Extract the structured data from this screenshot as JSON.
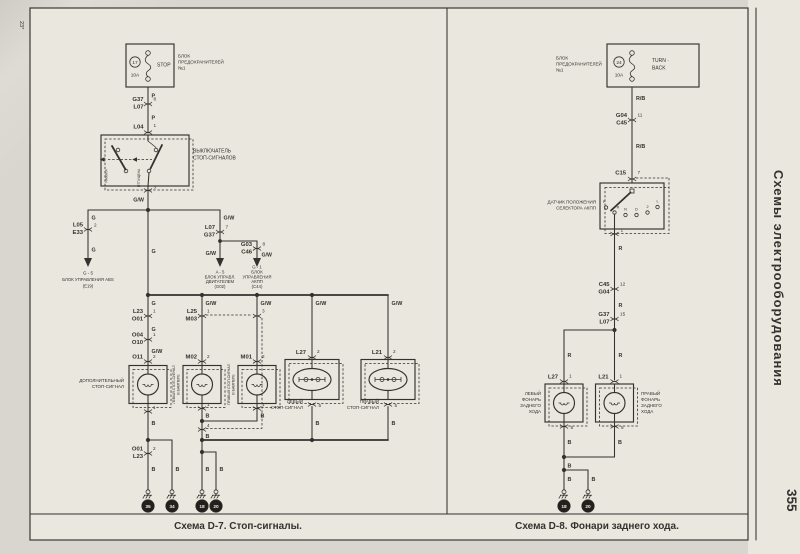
{
  "page": {
    "corner": "23*",
    "sidebar": "Схемы электрооборудования",
    "number": "355"
  },
  "colors": {
    "ink": "#33322e",
    "paper": "#eae7df",
    "page_bg": "#d9d6cf",
    "disc": "#21201c"
  },
  "d7": {
    "caption": "Схема D-7. Стоп-сигналы.",
    "fuse": {
      "num": "17",
      "amp": "10A",
      "name": "STOP",
      "box0": "БЛОК",
      "box1": "ПРЕДОХРАНИТЕЛЕЙ",
      "box2": "№1"
    },
    "w_p1": "P",
    "w_p2": "P",
    "cn1": {
      "a": "G37",
      "b": "L07",
      "pin": "8"
    },
    "cn2": {
      "a": "L04",
      "pin": "1"
    },
    "sw": {
      "name0": "ВЫКЛЮЧАТЕЛЬ",
      "name1": "СТОП-СИГНАЛОВ",
      "st0": "НАЖАТА",
      "st1": "ОТПУЩЕНА",
      "pin": "3",
      "out": "G/W"
    },
    "abs": {
      "w1": "G",
      "a": "L05",
      "b": "E33",
      "pin": "2",
      "w2": "G",
      "ref": "G - 5",
      "name": "БЛОК УПРАВЛЕНИЯ ABS",
      "code": "(E19)"
    },
    "ecu": {
      "w1": "G/W",
      "a": "L07",
      "b": "G37",
      "pin": "7",
      "w2": "G/W",
      "ref": "A - 5",
      "name0": "БЛОК УПРАВЛ.",
      "name1": "ДВИГАТЕЛЕМ",
      "code": "(G02)"
    },
    "tcu": {
      "a": "G03",
      "b": "C46",
      "pin": "8",
      "w": "G/W",
      "ref": "G - 1",
      "name0": "БЛОК",
      "name1": "УПРАВЛЕНИЯ",
      "name2": "АКПП",
      "code": "(C44)"
    },
    "feed_w": "G",
    "bus": {
      "w0": "G",
      "w1": "G/W",
      "w2": "G/W",
      "w3": "G/W",
      "w4": "G/W"
    },
    "o": {
      "c1a": "L23",
      "c1b": "O01",
      "c1p": "1",
      "w1": "G",
      "c2a": "O04",
      "c2b": "O10",
      "c2p": "1",
      "w2": "G/W",
      "id": "O11",
      "idp": "2",
      "name0": "ДОПОЛНИТЕЛЬНЫЙ",
      "name1": "СТОП-СИГНАЛ",
      "p1": "1",
      "wb": "B",
      "c3a": "O01",
      "c3b": "L23",
      "c3p": "2",
      "wg0": "B",
      "wg1": "B",
      "g0": "35",
      "g1": "34"
    },
    "m2": {
      "ca": "L25",
      "cb": "M03",
      "cp": "1",
      "cp3": "3",
      "id": "M02",
      "idp": "2",
      "v0": "ЛЕВЫЙ СТОП-СИГНАЛ",
      "v1": "В БАМПЕРЕ",
      "p1": "1",
      "wb": "B"
    },
    "m1": {
      "id": "M01",
      "idp": "2",
      "v0": "ПРАВЫЙ СТОП-СИГНАЛ",
      "v1": "В БАМПЕРЕ",
      "p1": "1",
      "wb": "B"
    },
    "mj": {
      "p4": "4",
      "wb": "B",
      "wg0": "B",
      "wg1": "B",
      "g0": "18",
      "g1": "20"
    },
    "l27": {
      "id": "L27",
      "idp": "2",
      "name0": "ЛЕВЫЙ",
      "name1": "СТОП-СИГНАЛ",
      "p5": "5",
      "wb": "B"
    },
    "l21": {
      "id": "L21",
      "idp": "2",
      "name0": "ПРАВЫЙ",
      "name1": "СТОП-СИГНАЛ",
      "p5": "5",
      "wb": "B"
    }
  },
  "d8": {
    "caption": "Схема D-8. Фонари заднего хода.",
    "fuse": {
      "box0": "БЛОК",
      "box1": "ПРЕДОХРАНИТЕЛЕЙ",
      "box2": "№1",
      "num": "24",
      "amp": "10A",
      "name0": "TURN ·",
      "name1": "BACK"
    },
    "w1": "R/B",
    "w2": "R/B",
    "cn1": {
      "a": "G04",
      "b": "C45",
      "pin": "11"
    },
    "c15": {
      "id": "C15",
      "pin": "7"
    },
    "sensor": {
      "name0": "ДАТЧИК ПОЛОЖЕНИЯ",
      "name1": "СЕЛЕКТОРА АКПП",
      "p": "P",
      "r": "R",
      "n": "N",
      "d": "D",
      "two": "2",
      "l": "L",
      "pin": "1"
    },
    "w3": "R",
    "cn2": {
      "a": "C45",
      "b": "G04",
      "pin": "12"
    },
    "w4": "R",
    "cn3": {
      "a": "G37",
      "b": "L07",
      "pin": "15"
    },
    "wl": "R",
    "wr": "R",
    "l27": {
      "id": "L27",
      "pin": "1",
      "n0": "ЛЕВЫЙ",
      "n1": "ФОНАРЬ",
      "n2": "ЗАДНЕГО",
      "n3": "ХОДА",
      "p5": "5",
      "wb": "B"
    },
    "l21": {
      "id": "L21",
      "pin": "1",
      "n0": "ПРАВЫЙ",
      "n1": "ФОНАРЬ",
      "n2": "ЗАДНЕГО",
      "n3": "ХОДА",
      "p5": "5",
      "wb": "B"
    },
    "join": {
      "wb": "B",
      "wg0": "B",
      "wg1": "B",
      "g0": "18",
      "g1": "20"
    }
  }
}
